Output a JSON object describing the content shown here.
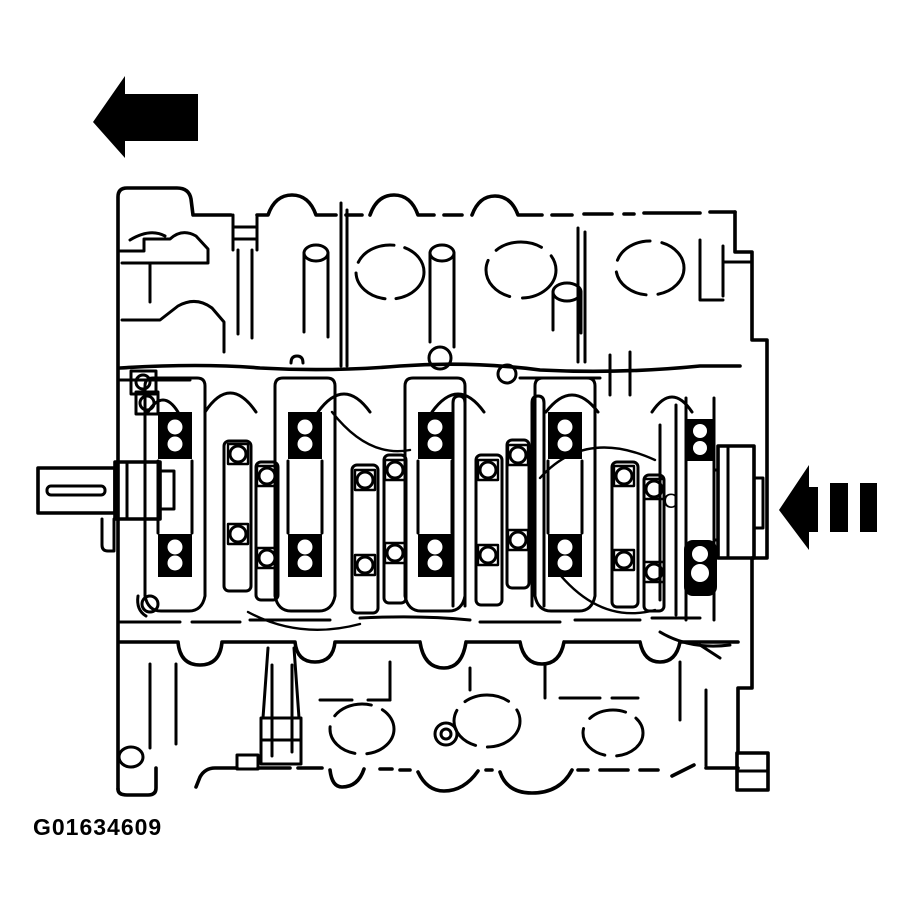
{
  "figure": {
    "code": "G01634609",
    "crankshaft_mark": "C"
  },
  "icons": {
    "top_left_arrow": "arrow-left-solid-icon",
    "right_arrow": "arrow-left-dashed-icon"
  },
  "colors": {
    "ink": "#000000",
    "background": "#ffffff"
  }
}
